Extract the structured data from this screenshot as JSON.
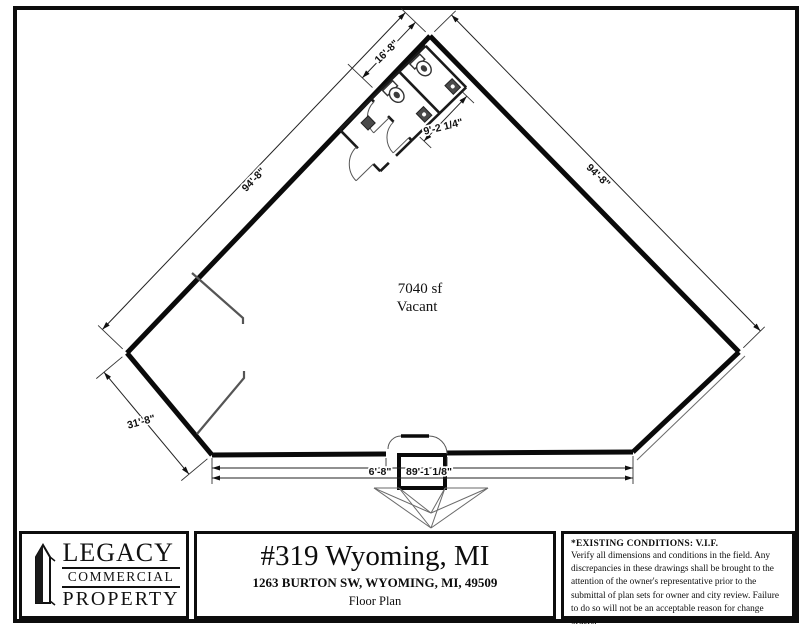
{
  "floor_plan": {
    "area": {
      "line1": "7040 sf",
      "line2": "Vacant"
    },
    "dims": {
      "top": "16'-8\"",
      "restroom": "9'-2 1/4\"",
      "left_wall": "94'-8\"",
      "right_wall": "94'-8\"",
      "lower_left_wall": "31'-8\"",
      "entry": "6'-8\"",
      "bottom_wall": "89'-1 1/8\""
    }
  },
  "title_block": {
    "logo": {
      "line1": "LEGACY",
      "line2": "COMMERCIAL",
      "line3": "PROPERTY"
    },
    "project_title": "#319 Wyoming, MI",
    "address": "1263 BURTON SW, WYOMING, MI, 49509",
    "drawing_name": "Floor Plan",
    "notes": {
      "heading": "*EXISTING CONDITIONS:  V.I.F.",
      "body": "Verify all dimensions and conditions in the field. Any discrepancies in these drawings shall be brought to the attention of the owner's representative prior to the submittal of plan sets for owner and city review. Failure to do so will not be an acceptable reason for change orders.",
      "date": "Date: 02/03/2021"
    }
  },
  "colors": {
    "ink": "#0d0d0d",
    "paper": "#ffffff",
    "light_line": "#555555"
  }
}
